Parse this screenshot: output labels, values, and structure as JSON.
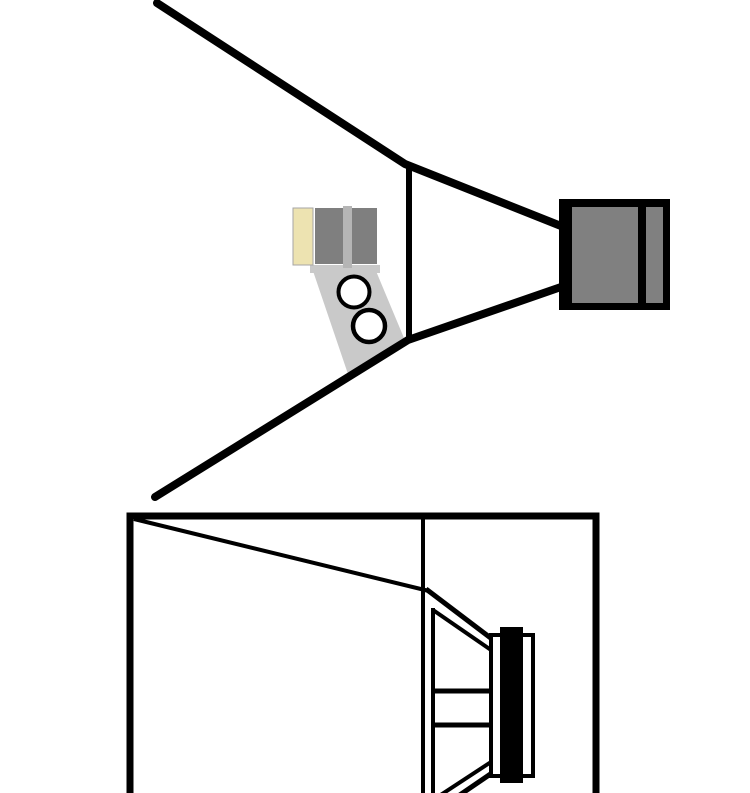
{
  "canvas": {
    "width": 750,
    "height": 793,
    "background": "#FFFFFF"
  },
  "colors": {
    "line": "#000000",
    "white": "#FFFFFF",
    "driver_gray": "#808080",
    "panel_gray": "#7F7F7F",
    "tan": "#EDE3B1",
    "light_gray_strip": "#B5B5B5",
    "bracket_gray": "#C9C9C9",
    "outline_gray": "#A6A6A6"
  },
  "top_diagram": {
    "label": "horn-speaker-side-view",
    "shapes": [
      {
        "name": "horn-bracket-arm",
        "type": "polygon",
        "points": "313,271 376,271 404,338 349,377",
        "fill": "bracket_gray"
      },
      {
        "name": "horn-mount-bar",
        "type": "rect",
        "x": 310,
        "y": 265,
        "w": 70,
        "h": 8,
        "fill": "bracket_gray"
      },
      {
        "name": "horn-tan-panel",
        "type": "rect",
        "x": 293,
        "y": 208,
        "w": 20,
        "h": 57,
        "fill": "tan",
        "stroke": "outline_gray",
        "sw": 1
      },
      {
        "name": "horn-panel-left",
        "type": "rect",
        "x": 315,
        "y": 208,
        "w": 28,
        "h": 56,
        "fill": "panel_gray"
      },
      {
        "name": "horn-panel-right",
        "type": "rect",
        "x": 352,
        "y": 208,
        "w": 25,
        "h": 56,
        "fill": "panel_gray"
      },
      {
        "name": "horn-center-strip",
        "type": "rect",
        "x": 343,
        "y": 206,
        "w": 9,
        "h": 62,
        "fill": "light_gray_strip"
      },
      {
        "name": "bracket-hole-top",
        "type": "circle",
        "cx": 354,
        "cy": 292,
        "r": 15.5,
        "fill": "white",
        "stroke": "line",
        "sw": 4
      },
      {
        "name": "bracket-hole-bottom",
        "type": "circle",
        "cx": 369,
        "cy": 326,
        "r": 16,
        "fill": "white",
        "stroke": "line",
        "sw": 4.5
      },
      {
        "name": "horn-top-wall",
        "type": "polyline",
        "points": "157,3 405,164 561,226",
        "stroke": "line",
        "sw": 8,
        "cap": "round"
      },
      {
        "name": "horn-bottom-wall",
        "type": "polyline",
        "points": "155,497 408,340 561,287",
        "stroke": "line",
        "sw": 8,
        "cap": "round"
      },
      {
        "name": "horn-throat-line",
        "type": "line",
        "x1": 409,
        "y1": 164,
        "x2": 409,
        "y2": 341,
        "stroke": "line",
        "sw": 6
      },
      {
        "name": "driver-housing",
        "type": "rect",
        "x": 559,
        "y": 199,
        "w": 111,
        "h": 111,
        "fill": "line"
      },
      {
        "name": "driver-body",
        "type": "rect",
        "x": 572,
        "y": 207,
        "w": 66,
        "h": 96,
        "fill": "driver_gray"
      },
      {
        "name": "driver-back-strip",
        "type": "rect",
        "x": 646,
        "y": 207,
        "w": 17,
        "h": 96,
        "fill": "driver_gray"
      }
    ]
  },
  "bottom_diagram": {
    "label": "cabinet-cross-section",
    "shapes": [
      {
        "name": "cabinet-outline",
        "type": "path",
        "d": "M130,793 L130,516 L596,516 L596,793",
        "stroke": "line",
        "sw": 7
      },
      {
        "name": "cabinet-brace-line",
        "type": "line",
        "x1": 134,
        "y1": 519,
        "x2": 429,
        "y2": 591,
        "stroke": "line",
        "sw": 4
      },
      {
        "name": "baffle-line",
        "type": "line",
        "x1": 423,
        "y1": 519,
        "x2": 423,
        "y2": 793,
        "stroke": "line",
        "sw": 4
      },
      {
        "name": "woofer-frame-line",
        "type": "line",
        "x1": 433,
        "y1": 608,
        "x2": 433,
        "y2": 793,
        "stroke": "line",
        "sw": 4
      },
      {
        "name": "woofer-cone-top-outer",
        "type": "line",
        "x1": 426,
        "y1": 589,
        "x2": 492,
        "y2": 639,
        "stroke": "line",
        "sw": 5
      },
      {
        "name": "woofer-cone-top-inner",
        "type": "line",
        "x1": 433,
        "y1": 610,
        "x2": 491,
        "y2": 650,
        "stroke": "line",
        "sw": 4
      },
      {
        "name": "woofer-spider-top",
        "type": "line",
        "x1": 431,
        "y1": 691,
        "x2": 492,
        "y2": 691,
        "stroke": "line",
        "sw": 5
      },
      {
        "name": "woofer-spider-bottom",
        "type": "line",
        "x1": 431,
        "y1": 725,
        "x2": 492,
        "y2": 725,
        "stroke": "line",
        "sw": 5
      },
      {
        "name": "woofer-cone-bottom-outer",
        "type": "line",
        "x1": 426,
        "y1": 818,
        "x2": 492,
        "y2": 773,
        "stroke": "line",
        "sw": 5
      },
      {
        "name": "woofer-cone-bottom-inner",
        "type": "line",
        "x1": 433,
        "y1": 800,
        "x2": 491,
        "y2": 762,
        "stroke": "line",
        "sw": 4
      },
      {
        "name": "woofer-front-plate",
        "type": "rect",
        "x": 491,
        "y": 635,
        "w": 42,
        "h": 141,
        "fill": "white",
        "stroke": "line",
        "sw": 4
      },
      {
        "name": "woofer-magnet",
        "type": "rect",
        "x": 500,
        "y": 627,
        "w": 23,
        "h": 156,
        "fill": "line"
      }
    ]
  }
}
